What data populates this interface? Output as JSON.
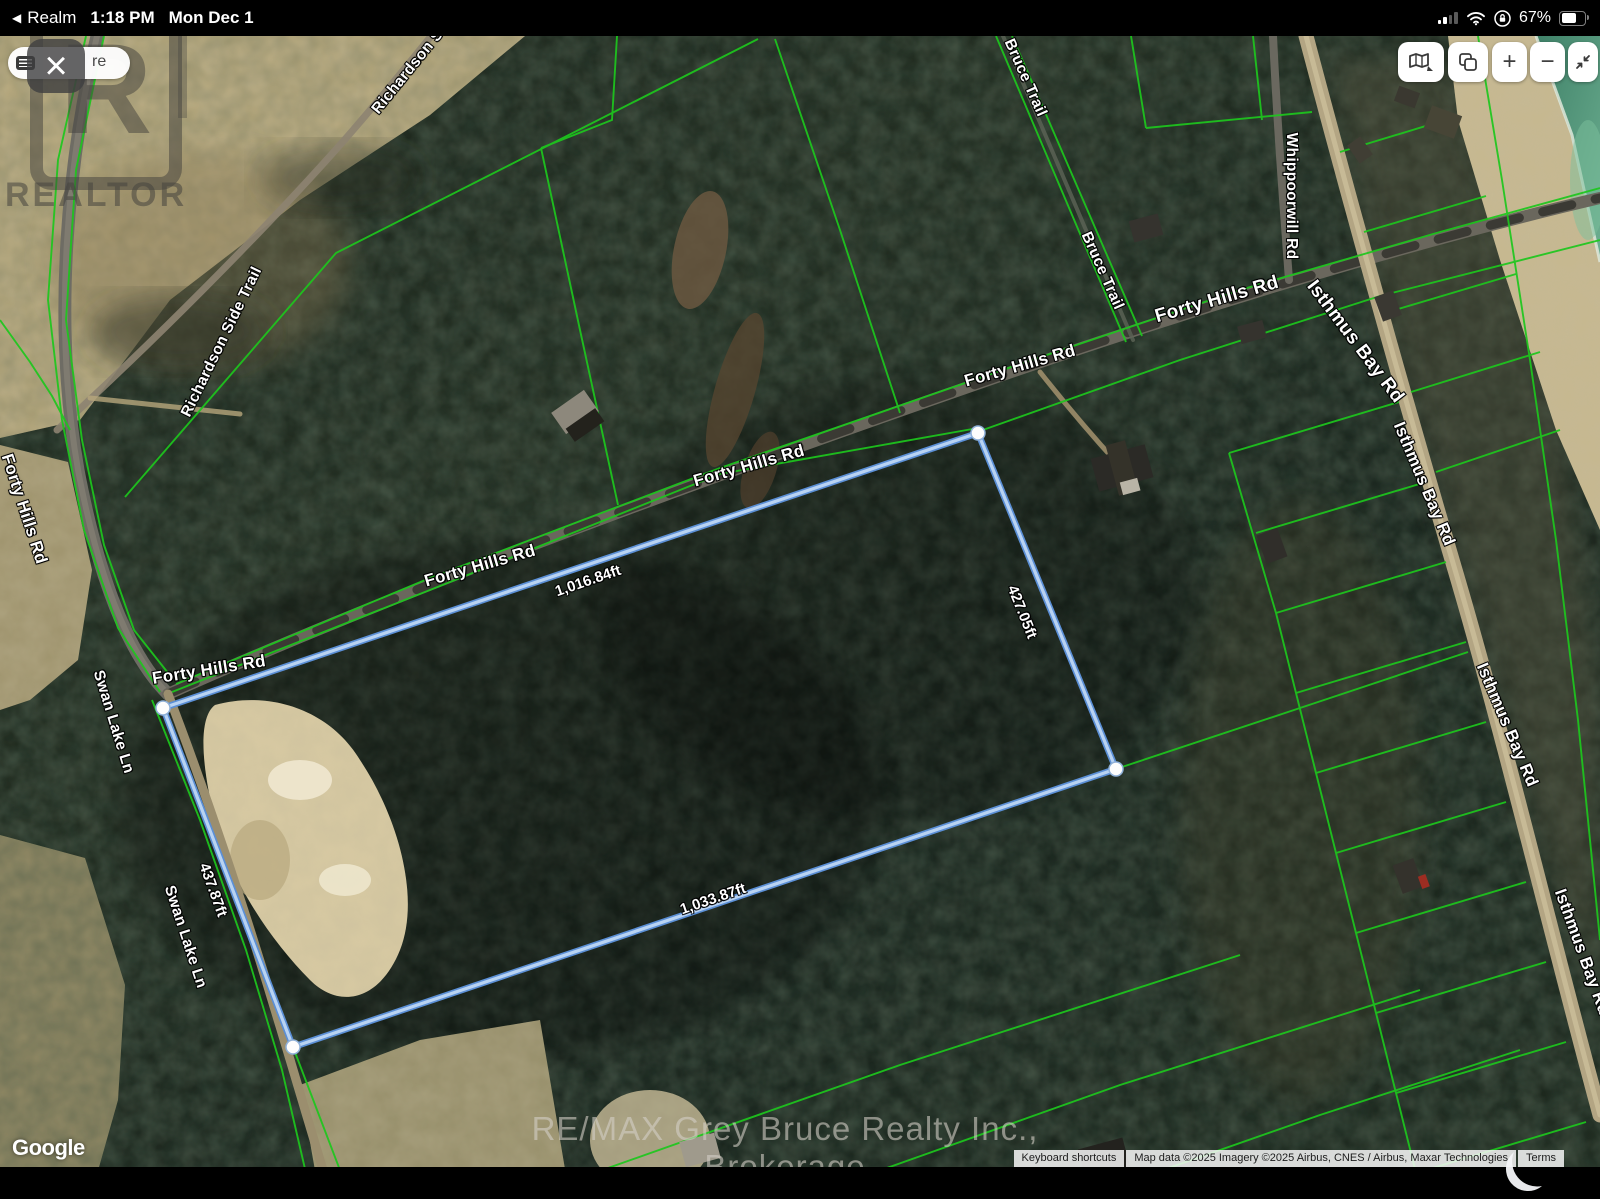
{
  "status_bar": {
    "back_icon": "◀",
    "back_app": "Realm",
    "time": "1:18 PM",
    "date": "Mon Dec 1",
    "battery_percent": "67%"
  },
  "toolbar": {
    "search_text": "re",
    "close_icon": "×"
  },
  "icons": {
    "back": "chevron-left",
    "search_left": "keyboard",
    "close": "x",
    "map_type": "folded-map",
    "layers": "copy-squares",
    "zoom_in": "plus",
    "zoom_out": "minus",
    "collapse": "arrows-inward",
    "signal": "cellular-bars",
    "wifi": "wifi",
    "rotation_lock": "lock-circle",
    "battery": "battery"
  },
  "map_controls": {
    "zoom_in": "+",
    "zoom_out": "−"
  },
  "watermark": {
    "realtor_letter": "R",
    "realtor_word": "REALTOR",
    "brokerage": "RE/MAX Grey Bruce Realty Inc., Brokerage",
    "google": "Google"
  },
  "attribution": {
    "keyboard_shortcuts": "Keyboard shortcuts",
    "map_data": "Map data ©2025 Imagery ©2025 Airbus, CNES / Airbus, Maxar Technologies",
    "terms": "Terms"
  },
  "roads": {
    "richardson_partial": "Richardson S",
    "richardson_side_trail": "Richardson Side Trail",
    "bruce_trail_1": "Bruce Trail",
    "bruce_trail_2": "Bruce Trail",
    "whippoorwill_rd": "Whippoorwill Rd",
    "forty_hills_rd_1": "Forty Hills Rd",
    "forty_hills_rd_2": "Forty Hills Rd",
    "forty_hills_rd_3": "Forty Hills Rd",
    "forty_hills_rd_4": "Forty Hills Rd",
    "forty_hills_rd_5": "Forty Hills Rd",
    "forty_hills_rd_6": "Forty Hills Rd",
    "swan_lake_ln_1": "Swan Lake Ln",
    "swan_lake_ln_2": "Swan Lake Ln",
    "isthmus_bay_rd_1": "Isthmus Bay Rd",
    "isthmus_bay_rd_2": "Isthmus Bay Rd",
    "isthmus_bay_rd_3": "Isthmus Bay Rd",
    "isthmus_bay_rd_4": "Isthmus Bay Rd"
  },
  "property": {
    "side_top": "1,016.84ft",
    "side_right": "427.05ft",
    "side_bottom": "1,033.87ft",
    "side_left": "437.87ft"
  },
  "colors": {
    "parcel_line": "#1dc71d",
    "boundary_outer": "#5b8fd6",
    "boundary_inner": "#b9d3f2",
    "water": "#4a8a6e",
    "status_bar_bg": "#000000"
  }
}
